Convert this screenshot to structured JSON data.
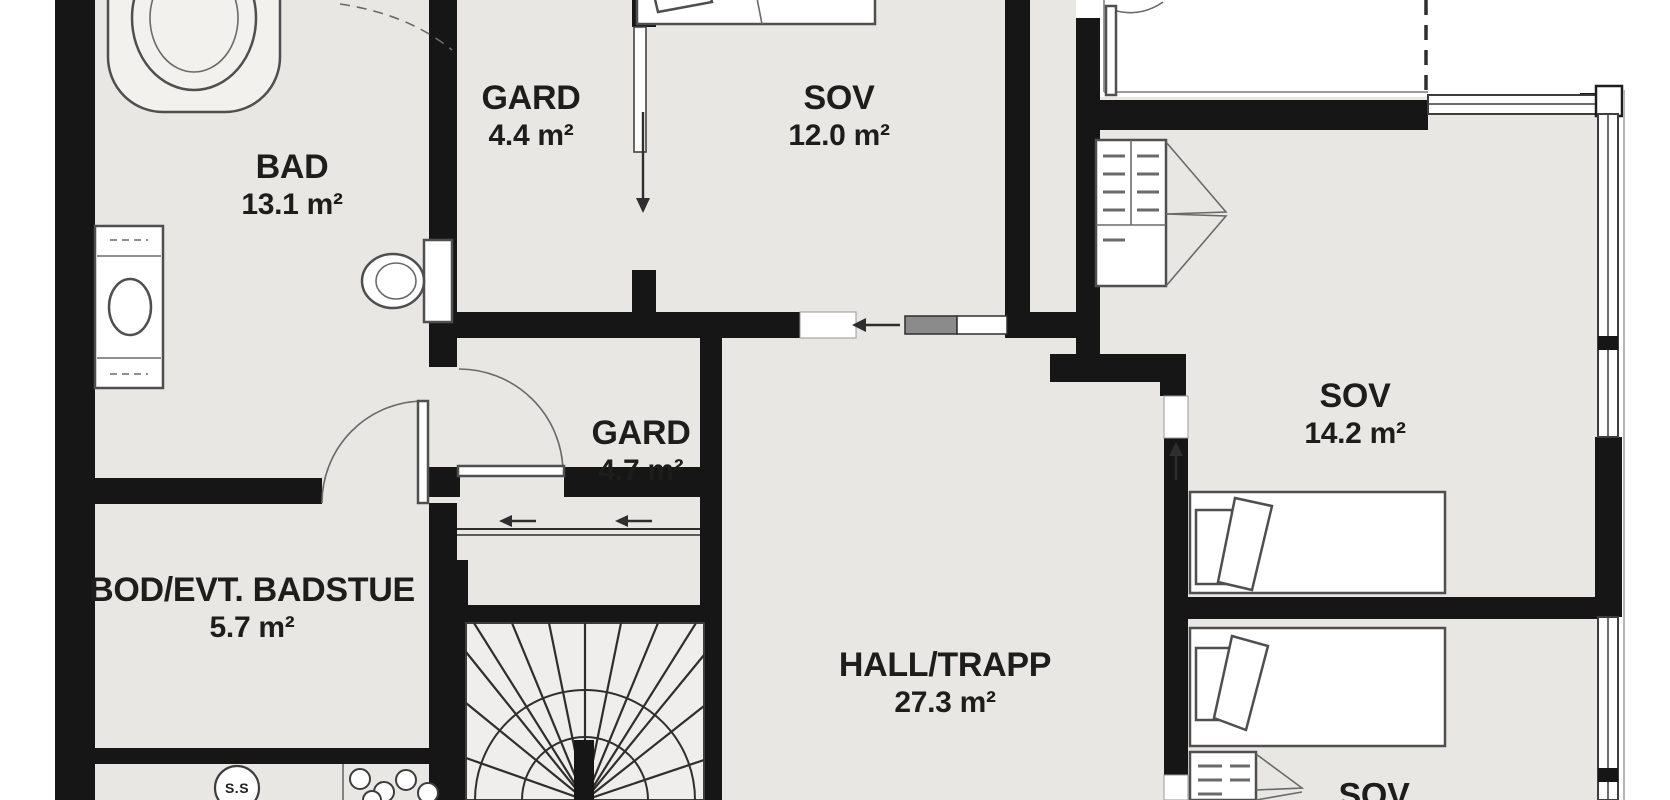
{
  "document_type": "floor-plan",
  "colors": {
    "floor": "#e9e7e3",
    "stair_floor": "#efeeec",
    "wall": "#161616",
    "outside": "#ffffff",
    "furniture_line": "#4f4f4f",
    "sliding_leaf": "#8b8b8b"
  },
  "rooms": [
    {
      "id": "bad",
      "name": "BAD",
      "area": "13.1 m²"
    },
    {
      "id": "gard-44",
      "name": "GARD",
      "area": "4.4 m²"
    },
    {
      "id": "sov-12",
      "name": "SOV",
      "area": "12.0 m²"
    },
    {
      "id": "gard-47",
      "name": "GARD",
      "area": "4.7 m²"
    },
    {
      "id": "bod",
      "name": "BOD/EVT. BADSTUE",
      "area": "5.7 m²"
    },
    {
      "id": "hall-trapp",
      "name": "HALL/TRAPP",
      "area": "27.3 m²"
    },
    {
      "id": "sov-142",
      "name": "SOV",
      "area": "14.2 m²"
    },
    {
      "id": "sov-bottom",
      "name": "SOV",
      "area": ""
    }
  ],
  "annotations": {
    "floor_drain": "S.S"
  },
  "fixtures": [
    "bathtub",
    "sink-cabinet",
    "toilet",
    "bed",
    "wardrobe",
    "winder-stairs",
    "balcony-door",
    "floor-drain",
    "laundry-basins"
  ]
}
